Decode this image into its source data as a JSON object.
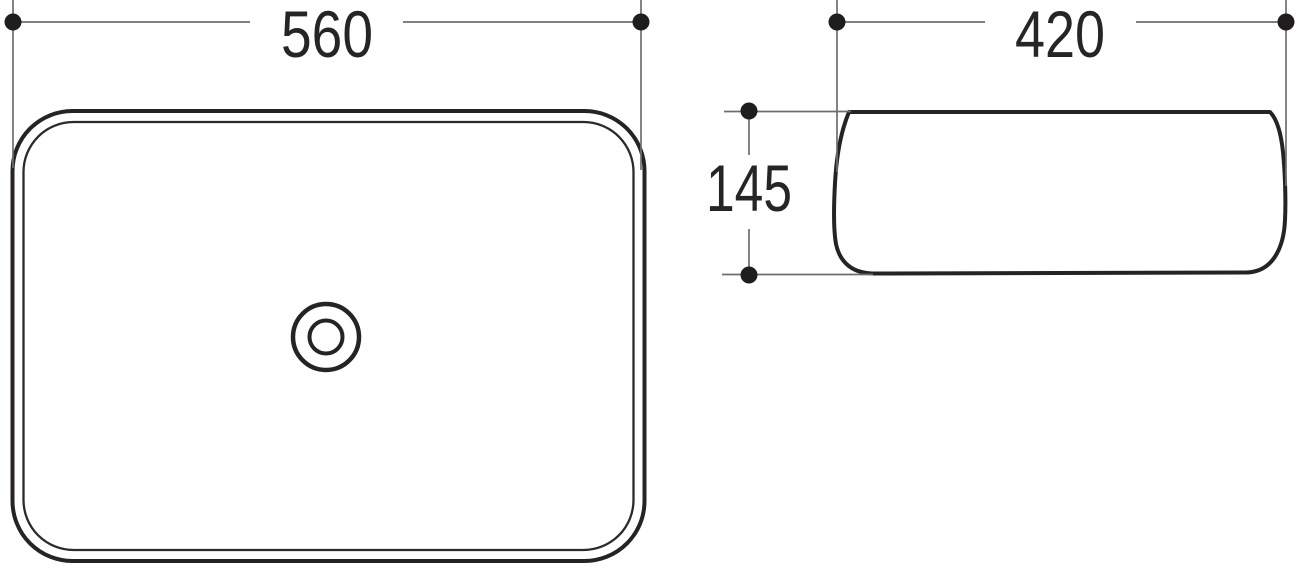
{
  "drawing": {
    "dimensions": {
      "top_view_width": "560",
      "side_view_width": "420",
      "side_view_height": "145"
    },
    "colors": {
      "outline": "#272325",
      "dimension_line": "#6e6e6e",
      "marker_dot": "#201d1e",
      "label_text": "#262427",
      "background": "#ffffff"
    }
  }
}
